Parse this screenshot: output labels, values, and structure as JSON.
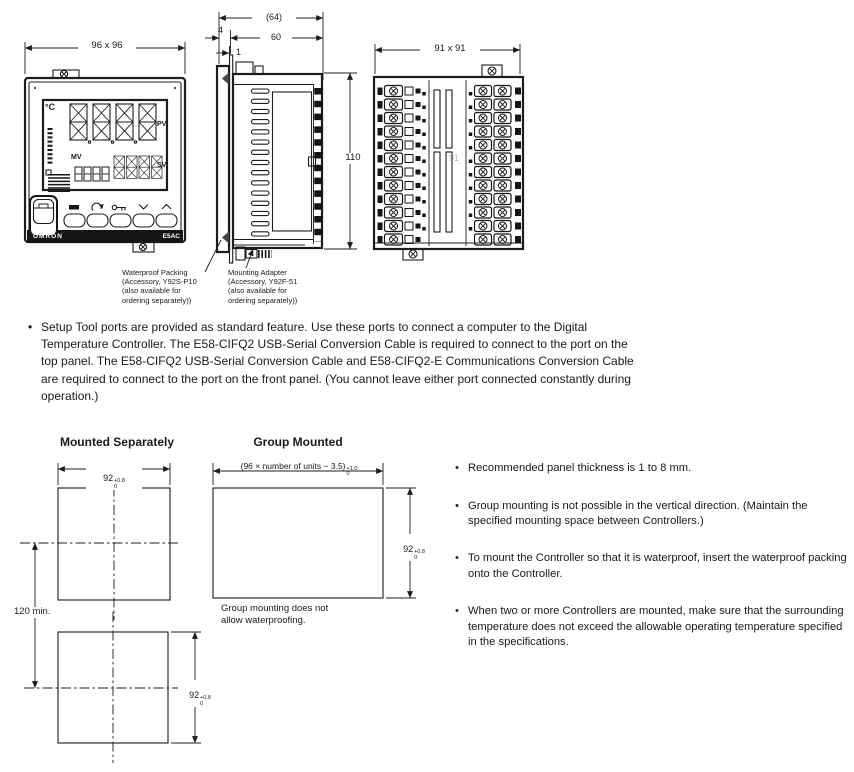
{
  "drawings": {
    "front": {
      "dim_label": "96 x 96",
      "unit": "°C",
      "pv": "PV",
      "sv": "SV",
      "mv": "MV",
      "brand": "OMRON",
      "model": "E5AC"
    },
    "side": {
      "dim_total": "(64)",
      "dim_body_depth": "60",
      "dim_bezel": "4",
      "dim_panel": "1",
      "dim_height": "110",
      "waterproof_label": "Waterproof Packing\n(Accessory, Y92S-P10\n(also available for\nordering separately))",
      "adapter_label": "Mounting Adapter\n(Accessory, Y92F-51\n(also available for\nordering separately))"
    },
    "rear": {
      "dim_label": "91 x 91",
      "center_dim": "91"
    }
  },
  "setup_note": {
    "bullet": "•",
    "text": "Setup Tool ports are provided as standard feature. Use these ports to connect a computer to the Digital Temperature Controller. The E58-CIFQ2 USB-Serial Conversion Cable is required to connect to the port on the top panel. The E58-CIFQ2 USB-Serial Conversion Cable and E58-CIFQ2-E Communications Conversion Cable are required to connect to the port on the front panel. (You cannot leave either port connected constantly during operation.)"
  },
  "mounting": {
    "separate_title": "Mounted Separately",
    "group_title": "Group Mounted",
    "group_width": {
      "prefix": "(96 × number of units − 3.5)",
      "tol_plus": "+1.0",
      "tol_minus": "0"
    },
    "cutout_92": {
      "value": "92",
      "tol_plus": "+0.8",
      "tol_minus": "0"
    },
    "vertical_pitch": "120 min.",
    "group_note": "Group mounting does not\nallow waterproofing.",
    "note_bullet": "•",
    "notes": [
      "Recommended panel thickness is 1 to 8 mm.",
      "Group mounting is not possible in the vertical direction. (Maintain the specified mounting space between Controllers.)",
      "To mount the Controller so that it is waterproof, insert the waterproof packing onto the Controller.",
      "When two or more Controllers are mounted, make sure that the surrounding temperature does not exceed the allowable operating temperature specified in the specifications."
    ]
  }
}
